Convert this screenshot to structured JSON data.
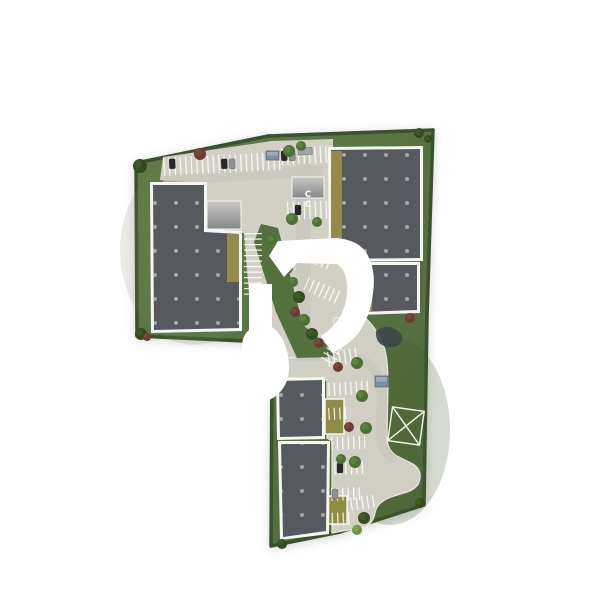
{
  "meta": {
    "description": "Aerial top-down 3D architectural site plan rendering of a commercial park with five warehouse buildings, parking lots, a curved access road, landscaping and a white developer logo watermark"
  },
  "palette": {
    "background": "#ffffff",
    "grass": "#57713f",
    "grass_light": "#6d8754",
    "grass_dark": "#43592f",
    "hedge": "#3a512e",
    "pavement": "#d4d2c8",
    "lane": "#c7c5bc",
    "curb": "#eceae2",
    "walkway": "#f5f5f1",
    "roof": "#56595d",
    "roof_dot": "#a6a8aa",
    "yellow_strip": "#948a4b",
    "yellow_island": "#8f8c44",
    "stripe": "#ffffff",
    "pond": "#40464a",
    "tree_green": "#4c7034",
    "tree_green_hi": "#5f8440",
    "tree_dark": "#324b20",
    "tree_dark_hi": "#3f5c2a",
    "tree_red": "#6b3c31",
    "tree_red_hi": "#7c4a3c",
    "tree_bright": "#699140",
    "tree_bright_hi": "#7ba74e",
    "car_dark": "#27292b",
    "car_gray": "#8e9296",
    "shed_blue": "#7e8fa2",
    "ramp_light": "#c9c8c4",
    "ramp_dark": "#85868a",
    "watermark": "#ffffff",
    "mark_white": "#f6f6f3"
  },
  "scene": {
    "site_outline": "136,163 268,136 433,130 427,317 424,505 340,532 271,546 272,357 244,341 137,336",
    "grass_patches": [
      {
        "cx": 195,
        "cy": 250,
        "rx": 75,
        "ry": 95,
        "color": "grass_light",
        "opacity": 0.16
      },
      {
        "cx": 390,
        "cy": 430,
        "rx": 60,
        "ry": 95,
        "color": "grass_dark",
        "opacity": 0.22
      }
    ],
    "pavements": [
      {
        "name": "upper-parking-court",
        "d": "M160,180 L163,157 L272,141 L333,139 L333,152 L330,152 L330,262 L357,263 L357,316 L334,319 L334,353 L281,359 L252,330 L244,233 L207,230 L207,183 Z",
        "stroke": false
      },
      {
        "name": "south-access-road",
        "d": "M281,359 L334,353 L334,318 L362,315 Q378,328 385,350 Q388,362 388,384 L387,437 Q387,450 397,456 L413,464 Q421,469 420,478 Q419,488 407,492 L391,497 Q377,502 375,513 Q373,524 364,527 L332,533 L332,441 L327,438 L327,380 L281,377 Z",
        "stroke": true
      }
    ],
    "lanes": [
      {
        "x": 163,
        "y": 174,
        "w": 160,
        "h": 11,
        "rot": -3
      },
      {
        "x": 296,
        "y": 158,
        "w": 15,
        "h": 196,
        "rot": 0
      }
    ],
    "lane_paths": [
      {
        "d": "M300,357 Q345,352 366,362 Q381,372 382,396 L381,437 Q381,451 392,458"
      }
    ],
    "green_strip": "261,224 278,228 303,325 333,350 334,357 297,358 276,312 254,242",
    "parking_rows": [
      [
        163,
        158,
        118,
        18,
        -3,
        "v"
      ],
      [
        281,
        148,
        50,
        17,
        -3,
        "v"
      ],
      [
        287,
        202,
        45,
        18,
        -2,
        "v"
      ],
      [
        244,
        233,
        18,
        66,
        0,
        "h"
      ],
      [
        301,
        243,
        38,
        14,
        24,
        "v"
      ],
      [
        309,
        277,
        36,
        14,
        24,
        "v"
      ],
      [
        327,
        352,
        32,
        15,
        -8,
        "v"
      ],
      [
        342,
        318,
        15,
        48,
        28,
        "h"
      ],
      [
        328,
        383,
        40,
        13,
        -3,
        "v"
      ],
      [
        328,
        408,
        22,
        12,
        -3,
        "v"
      ],
      [
        331,
        437,
        34,
        13,
        -2,
        "v"
      ],
      [
        334,
        462,
        30,
        13,
        -2,
        "v"
      ],
      [
        331,
        488,
        30,
        13,
        -2,
        "v"
      ],
      [
        350,
        498,
        24,
        13,
        -8,
        "v"
      ],
      [
        326,
        513,
        26,
        13,
        -2,
        "v"
      ]
    ],
    "islands": [
      [
        325,
        399,
        19,
        35
      ],
      [
        328,
        496,
        19,
        28
      ]
    ],
    "ramps": [
      [
        207,
        201,
        34,
        28
      ],
      [
        292,
        177,
        32,
        21
      ]
    ],
    "buildings": [
      {
        "name": "warehouse-a",
        "footprint": "150,182 207,182 207,229 242,231 242,331 151,333",
        "roof": "153,185 204,185 204,232 239,234 239,328 154,330",
        "strip": [
          227,
          234,
          12,
          48
        ]
      },
      {
        "name": "warehouse-b",
        "footprint": "328,147 423,146 423,261 329,262",
        "roof": "331,150 420,149 420,258 332,259",
        "strip": [
          331,
          151,
          11,
          107
        ]
      },
      {
        "name": "warehouse-c",
        "footprint": "356,262 420,262 420,313 357,315",
        "roof": "359,265 417,265 417,310 360,312",
        "strip": [
          359,
          265,
          13,
          46
        ]
      },
      {
        "name": "warehouse-d",
        "footprint": "276,378 325,377 325,439 277,440",
        "roof": "279,381 322,380 322,436 280,437"
      },
      {
        "name": "warehouse-e",
        "footprint": "278,441 330,441 329,534 280,540",
        "roof": "281,444 327,444 326,531 283,537"
      }
    ],
    "pond": "M376,331 Q383,325 393,328 Q403,332 402,340 Q400,348 387,347 Q375,344 376,331 Z",
    "plot_marker": {
      "cx": 406,
      "cy": 426,
      "w": 32,
      "h": 34,
      "rot": 8
    },
    "pavement_letters": {
      "text": "C",
      "positions": [
        [
          308,
          197
        ],
        [
          308,
          207
        ]
      ]
    },
    "sheds": [
      [
        266,
        151,
        13,
        9
      ],
      [
        375,
        376,
        13,
        11
      ]
    ],
    "trailer": [
      298,
      148,
      14,
      7,
      -3
    ],
    "vehicles": [
      [
        169,
        159,
        6,
        10,
        "car_dark",
        -3
      ],
      [
        221,
        159,
        6,
        10,
        "car_dark",
        -3
      ],
      [
        229,
        159,
        6,
        10,
        "car_gray",
        -3
      ],
      [
        281,
        151,
        6,
        10,
        "car_dark",
        -3
      ],
      [
        289,
        151,
        6,
        10,
        "car_gray",
        -3
      ],
      [
        295,
        205,
        6,
        10,
        "car_dark",
        0
      ],
      [
        337,
        463,
        6,
        10,
        "car_dark",
        0
      ],
      [
        332,
        489,
        6,
        10,
        "car_gray",
        0
      ]
    ],
    "trees": [
      [
        140,
        166,
        7,
        "dark"
      ],
      [
        200,
        154,
        6,
        "red"
      ],
      [
        289,
        151,
        6,
        "green"
      ],
      [
        301,
        146,
        5,
        "green"
      ],
      [
        419,
        133,
        5,
        "dark"
      ],
      [
        428,
        139,
        4,
        "dark"
      ],
      [
        292,
        219,
        6,
        "green"
      ],
      [
        317,
        222,
        5,
        "green"
      ],
      [
        141,
        334,
        6,
        "dark"
      ],
      [
        147,
        337,
        4,
        "red"
      ],
      [
        272,
        240,
        5,
        "green"
      ],
      [
        280,
        254,
        6,
        "dark"
      ],
      [
        287,
        268,
        6,
        "green"
      ],
      [
        293,
        282,
        5,
        "green"
      ],
      [
        299,
        297,
        6,
        "dark"
      ],
      [
        295,
        312,
        5,
        "red"
      ],
      [
        304,
        320,
        6,
        "green"
      ],
      [
        312,
        334,
        6,
        "dark"
      ],
      [
        319,
        343,
        5,
        "red"
      ],
      [
        410,
        318,
        5,
        "red"
      ],
      [
        334,
        338,
        5,
        "green"
      ],
      [
        338,
        367,
        5,
        "red"
      ],
      [
        357,
        363,
        6,
        "green"
      ],
      [
        362,
        396,
        6,
        "green"
      ],
      [
        349,
        427,
        5,
        "red"
      ],
      [
        366,
        428,
        6,
        "green"
      ],
      [
        341,
        459,
        5,
        "green"
      ],
      [
        355,
        462,
        6,
        "green"
      ],
      [
        364,
        518,
        6,
        "dark"
      ],
      [
        357,
        530,
        5,
        "bright"
      ],
      [
        282,
        544,
        5,
        "dark"
      ],
      [
        420,
        503,
        5,
        "dark"
      ]
    ],
    "watermark": {
      "name": "developer-logo",
      "paths": [
        "M278,241 L336,238 Q362,240 369,258 Q376,273 373,293 Q371,316 357,335 Q347,346 332,353 L321,336 Q335,327 342,313 Q348,300 347,285 Q346,269 337,264 L297,263 L284,277 L269,256 Z",
        "M249,284 L272,284 L272,327 Q287,338 289,364 Q290,387 273,398 Q259,406 249,401 Q242,397 242,386 L242,347 Q242,336 249,330 Z"
      ]
    }
  }
}
